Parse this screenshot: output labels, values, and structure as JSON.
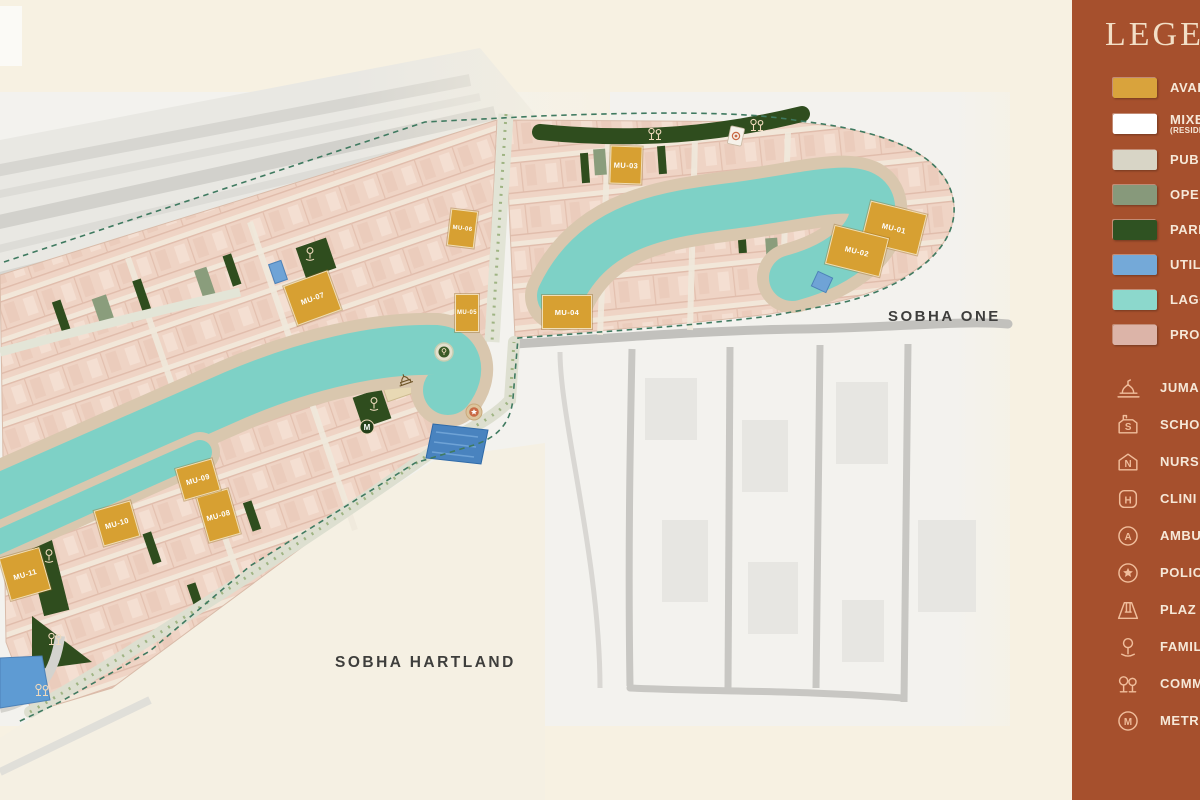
{
  "map": {
    "area_labels": [
      {
        "text": "SOBHA ONE",
        "x": 932,
        "y": 317
      },
      {
        "text": "SOBHA HARTLAND",
        "x": 400,
        "y": 663
      }
    ],
    "plots": [
      {
        "id": "MU-01",
        "x": 893,
        "y": 227,
        "w": 56,
        "h": 40,
        "r": 14
      },
      {
        "id": "MU-02",
        "x": 856,
        "y": 250,
        "w": 54,
        "h": 38,
        "r": 14
      },
      {
        "id": "MU-03",
        "x": 625,
        "y": 164,
        "w": 30,
        "h": 36,
        "r": 2
      },
      {
        "id": "MU-04",
        "x": 566,
        "y": 311,
        "w": 48,
        "h": 32,
        "r": 0
      },
      {
        "id": "MU-05",
        "x": 466,
        "y": 312,
        "w": 22,
        "h": 36,
        "r": 0
      },
      {
        "id": "MU-06",
        "x": 461,
        "y": 227,
        "w": 25,
        "h": 35,
        "r": 7
      },
      {
        "id": "MU-07",
        "x": 311,
        "y": 297,
        "w": 45,
        "h": 40,
        "r": -20
      },
      {
        "id": "MU-08",
        "x": 217,
        "y": 514,
        "w": 31,
        "h": 45,
        "r": -16
      },
      {
        "id": "MU-09",
        "x": 197,
        "y": 478,
        "w": 36,
        "h": 31,
        "r": -16
      },
      {
        "id": "MU-10",
        "x": 116,
        "y": 522,
        "w": 36,
        "h": 35,
        "r": -16
      },
      {
        "id": "MU-11",
        "x": 24,
        "y": 573,
        "w": 40,
        "h": 42,
        "r": -16
      }
    ],
    "poi": [
      {
        "type": "community-trees-icon",
        "x": 655,
        "y": 134
      },
      {
        "type": "community-trees-icon",
        "x": 757,
        "y": 125
      },
      {
        "type": "police-card-icon",
        "x": 736,
        "y": 136
      },
      {
        "type": "family-tree-icon",
        "x": 310,
        "y": 254
      },
      {
        "type": "roundabout-tree-icon",
        "x": 444,
        "y": 352
      },
      {
        "type": "mosque-icon",
        "x": 405,
        "y": 380
      },
      {
        "type": "family-tree-icon",
        "x": 374,
        "y": 404
      },
      {
        "type": "metro-icon",
        "x": 367,
        "y": 427
      },
      {
        "type": "police-star-icon",
        "x": 474,
        "y": 412
      },
      {
        "type": "family-tree-icon",
        "x": 49,
        "y": 556
      },
      {
        "type": "community-trees-icon",
        "x": 55,
        "y": 639
      },
      {
        "type": "community-trees-icon",
        "x": 42,
        "y": 690
      }
    ],
    "colors": {
      "lagoon": "#7ED1C6",
      "promenade": "#D9C7AE",
      "plot_gold": "#D7A032",
      "park_green": "#2F4D1E",
      "open_sage": "#8A9D7C",
      "utility_blue": "#6FA3D6",
      "boundary": "#3F7A60"
    }
  },
  "legend": {
    "title": "LEGEN",
    "panel_color": "#A6502D",
    "swatches": [
      {
        "label": "AVAIL",
        "color": "#D9A33C"
      },
      {
        "label": "MIXED",
        "sub": "(RESIDE",
        "color": "#FFFFFF"
      },
      {
        "label": "PUBL",
        "color": "#D8D5C6"
      },
      {
        "label": "OPEN",
        "color": "#87997B"
      },
      {
        "label": "PARK",
        "color": "#2F5222"
      },
      {
        "label": "UTILIT",
        "color": "#74A9D8"
      },
      {
        "label": "LAGO",
        "color": "#8CD8CC"
      },
      {
        "label": "PROM",
        "color": "#DCB4A8"
      }
    ],
    "icons": [
      {
        "label": "JUMA",
        "icon": "mosque-icon"
      },
      {
        "label": "SCHO",
        "icon": "school-icon"
      },
      {
        "label": "NURS",
        "icon": "nursery-icon"
      },
      {
        "label": "CLINI",
        "icon": "clinic-icon"
      },
      {
        "label": "AMBU",
        "icon": "ambulance-icon"
      },
      {
        "label": "POLIC",
        "icon": "police-icon"
      },
      {
        "label": "PLAZ",
        "icon": "plaza-icon"
      },
      {
        "label": "FAMIL",
        "icon": "family-icon"
      },
      {
        "label": "COMM",
        "icon": "community-icon"
      },
      {
        "label": "METR",
        "icon": "metro-icon"
      }
    ]
  }
}
